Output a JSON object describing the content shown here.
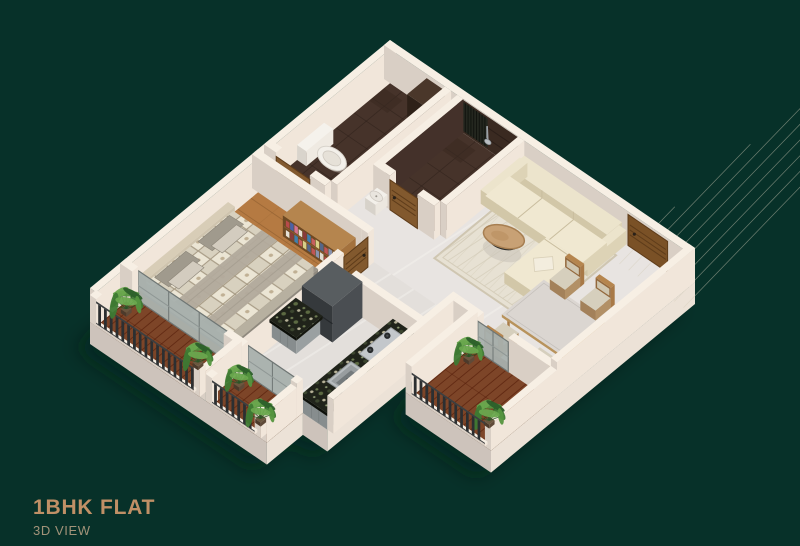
{
  "page": {
    "width": 800,
    "height": 546,
    "background": "#073129"
  },
  "caption": {
    "title": "1BHK FLAT",
    "subtitle": "3D VIEW",
    "title_color": "#c09066",
    "subtitle_color": "#a29379"
  },
  "scene": {
    "projection": {
      "ox": 390,
      "oy": 74,
      "ux": [
        3.05,
        2.08
      ],
      "vx": [
        -3.0,
        2.48
      ],
      "wall_h": 34
    },
    "palette": {
      "wall_top": "#f7efe4",
      "wall_se": "#f1e6da",
      "wall_sw": "#d9cfc5",
      "plinth_se": "#ece2d7",
      "plinth_sw": "#cdc3bb",
      "marble": "#e8e4e1",
      "marble2": "#e3dfdb",
      "wood_floor": "#b57a42",
      "wood_line": "#8f5f30",
      "deck": "#7d4528",
      "deck_line": "#571f0c",
      "tile_dark": "#46332a",
      "tile_line": "#2e211b",
      "rug": "#e7e1d3",
      "rug_line": "#d5cdba",
      "railing_dark": "#2c2f31",
      "glass": "#a8b0ad",
      "door_wood": "#82592e",
      "sofa_cream": "#ece4cc",
      "granite": "#20231a",
      "shadow": "#02211a"
    },
    "rooms": [
      "bedroom",
      "bathroom-wc",
      "bathroom-shower",
      "living-room",
      "dining-area",
      "kitchen",
      "bedroom-balcony",
      "kitchen-balcony",
      "dining-balcony"
    ],
    "elements": [
      {
        "t": "shadow",
        "name": "building-shadow",
        "pts": [
          [
            0,
            0
          ],
          [
            100,
            0
          ],
          [
            100,
            68
          ],
          [
            72,
            68
          ],
          [
            72,
            46
          ],
          [
            66,
            46
          ],
          [
            66,
            88
          ],
          [
            58,
            88
          ],
          [
            58,
            100
          ],
          [
            0,
            100
          ]
        ],
        "dx": -14,
        "dy": 26
      },
      {
        "t": "plinth",
        "name": "plinth-front-left",
        "edge": [
          0,
          100,
          58,
          100
        ],
        "side": "sw",
        "drop": 22
      },
      {
        "t": "plinth",
        "name": "plinth-kbal-e",
        "edge": [
          58,
          88,
          58,
          100
        ],
        "side": "se",
        "drop": 22
      },
      {
        "t": "plinth",
        "name": "plinth-kit-s",
        "edge": [
          58,
          88,
          66,
          88
        ],
        "side": "sw",
        "drop": 22
      },
      {
        "t": "plinth",
        "name": "plinth-kit-e",
        "edge": [
          66,
          46,
          66,
          88
        ],
        "side": "se",
        "drop": 22
      },
      {
        "t": "plinth",
        "name": "plinth-notch",
        "edge": [
          66,
          46,
          72,
          46
        ],
        "side": "sw",
        "drop": 22
      },
      {
        "t": "plinth",
        "name": "plinth-dbal-s",
        "edge": [
          72,
          68,
          100,
          68
        ],
        "side": "sw",
        "drop": 22
      },
      {
        "t": "plinth",
        "name": "plinth-e",
        "edge": [
          100,
          0,
          100,
          68
        ],
        "side": "se",
        "drop": 22
      },
      {
        "t": "floor",
        "name": "floor-living-marble",
        "rect": [
          0,
          0,
          100,
          46
        ],
        "tex": "marble"
      },
      {
        "t": "floor",
        "name": "floor-bath-wc",
        "rect": [
          0,
          2,
          20,
          40
        ],
        "tex": "tile"
      },
      {
        "t": "floor",
        "name": "floor-bath-shower",
        "rect": [
          24,
          2,
          44,
          28
        ],
        "tex": "tile"
      },
      {
        "t": "floor",
        "name": "floor-kitchen",
        "rect": [
          36,
          44,
          66,
          88
        ],
        "tex": "marble2"
      },
      {
        "t": "floor",
        "name": "floor-bedroom-wood",
        "rect": [
          0,
          44,
          36,
          88
        ],
        "tex": "wood"
      },
      {
        "t": "floor",
        "name": "floor-deck-bedroom",
        "rect": [
          0,
          88,
          36,
          100
        ],
        "tex": "deck"
      },
      {
        "t": "floor",
        "name": "floor-deck-kitchen",
        "rect": [
          38,
          88,
          58,
          100
        ],
        "tex": "deck"
      },
      {
        "t": "floor",
        "name": "floor-deck-dining",
        "rect": [
          72,
          46,
          100,
          68
        ],
        "tex": "deck"
      },
      {
        "t": "floor",
        "name": "living-room-rug",
        "rect": [
          48,
          6,
          80,
          34
        ],
        "tex": "rug"
      },
      {
        "t": "wall",
        "name": "wall-nw",
        "rect": [
          0,
          0,
          2,
          100
        ],
        "h": 34
      },
      {
        "t": "wall",
        "name": "wall-ne",
        "rect": [
          0,
          0,
          100,
          2
        ],
        "h": 34
      },
      {
        "t": "panelU",
        "name": "bath-shower-dark-wall",
        "c": 2,
        "a1": 24,
        "a2": 44,
        "h1": 0,
        "h2": 33,
        "fill": "#3a2a21",
        "hlines": 2,
        "lc": "#2c1f19"
      },
      {
        "t": "panelU",
        "name": "vent-slat-panel",
        "c": 2,
        "a1": 24.8,
        "a2": 34,
        "h1": 2,
        "h2": 31,
        "fill": "#24271f",
        "vlines": 9,
        "lc": "#12140f"
      },
      {
        "t": "shower",
        "name": "shower-head",
        "u": 34,
        "v": 2.2
      },
      {
        "t": "toilet",
        "name": "toilet-wc"
      },
      {
        "t": "prism",
        "name": "bath-dark-cabinet",
        "rect": [
          14,
          2,
          20,
          8.5
        ],
        "h": 30,
        "cols": {
          "t": "#4a372a",
          "se": "#3a2a1f",
          "sw": "#2e2118"
        }
      },
      {
        "t": "wall",
        "name": "wall-bath-divider",
        "rect": [
          20,
          2,
          22,
          40
        ],
        "h": 34
      },
      {
        "t": "wall",
        "name": "wall-bath2-w",
        "rect": [
          24,
          2,
          26,
          28
        ],
        "h": 34,
        "cols": {
          "t": "#f6eee3",
          "se": "#44312a",
          "sw": "#dcd2c8"
        }
      },
      {
        "t": "wall",
        "name": "wall-bath2-e",
        "rect": [
          44,
          2,
          46,
          28
        ],
        "h": 34
      },
      {
        "t": "wall",
        "name": "wall-bath2-s1",
        "rect": [
          24,
          28,
          29.5,
          30
        ],
        "h": 34
      },
      {
        "t": "wall",
        "name": "wall-bath2-s2",
        "rect": [
          38.5,
          28,
          44,
          30
        ],
        "h": 34
      },
      {
        "t": "door",
        "name": "bath-shower-door",
        "plane": "v",
        "c": 30,
        "a1": 29.5,
        "a2": 38.5,
        "h": 30
      },
      {
        "t": "basin",
        "name": "washbasin"
      },
      {
        "t": "wall",
        "name": "wall-bath1-s1",
        "rect": [
          0,
          40,
          4,
          42
        ],
        "h": 34
      },
      {
        "t": "wall",
        "name": "wall-bath1-s2",
        "rect": [
          15,
          40,
          20,
          42
        ],
        "h": 34
      },
      {
        "t": "door",
        "name": "bath-wc-door",
        "plane": "v",
        "c": 42,
        "a1": 4,
        "a2": 15,
        "h": 30
      },
      {
        "t": "door",
        "name": "entrance-door",
        "plane": "v",
        "c": 2,
        "a1": 80,
        "a2": 93,
        "h": 31,
        "fill": "#7a5126"
      },
      {
        "t": "wall",
        "name": "wall-bedroom-n",
        "rect": [
          0,
          44,
          36,
          46
        ],
        "h": 34
      },
      {
        "t": "bookshelf",
        "name": "bookshelf",
        "rect": [
          16,
          46,
          34,
          52
        ],
        "h": 21
      },
      {
        "t": "wall",
        "name": "wall-bedroom-e1",
        "rect": [
          36,
          44,
          38,
          46
        ],
        "h": 34
      },
      {
        "t": "wall",
        "name": "wall-bedroom-e2",
        "rect": [
          36,
          54,
          38,
          88
        ],
        "h": 34
      },
      {
        "t": "door",
        "name": "bedroom-door",
        "plane": "u",
        "c": 38,
        "a1": 46,
        "a2": 54,
        "h": 30
      },
      {
        "t": "bed",
        "name": "double-bed"
      },
      {
        "t": "sofa",
        "name": "l-shaped-sofa"
      },
      {
        "t": "ctable",
        "name": "coffee-table",
        "u": 58,
        "v": 21
      },
      {
        "t": "wall",
        "name": "wall-living-kitchen",
        "rect": [
          44,
          56,
          66,
          58
        ],
        "h": 34
      },
      {
        "t": "fridge",
        "name": "refrigerator",
        "rect": [
          38,
          58,
          48,
          68
        ],
        "h": 36
      },
      {
        "t": "counter",
        "name": "kitchen-counter-small",
        "rect": [
          36,
          68,
          44,
          76
        ],
        "h": 15
      },
      {
        "t": "counter",
        "name": "kitchen-counter-long",
        "rect": [
          58,
          58,
          66,
          88
        ],
        "h": 15
      },
      {
        "t": "stove",
        "name": "gas-stove",
        "rect": [
          59.3,
          60,
          64.7,
          70.5
        ]
      },
      {
        "t": "sink",
        "name": "kitchen-sink",
        "rect": [
          59.5,
          73.5,
          65,
          81.5
        ]
      },
      {
        "t": "wall",
        "name": "wall-kitchen-e",
        "rect": [
          66,
          46,
          68,
          88
        ],
        "h": 34
      },
      {
        "t": "dtable",
        "name": "dining-table",
        "rect": [
          76,
          26,
          96,
          40
        ]
      },
      {
        "t": "chair",
        "name": "dining-chair-1",
        "u": 78,
        "v": 21,
        "dir": "ne"
      },
      {
        "t": "chair",
        "name": "dining-chair-2",
        "u": 88,
        "v": 21,
        "dir": "ne"
      },
      {
        "t": "chair",
        "name": "dining-chair-3",
        "u": 79,
        "v": 42.5,
        "dir": "sw"
      },
      {
        "t": "chair",
        "name": "dining-chair-4",
        "u": 91,
        "v": 42.5,
        "dir": "sw"
      },
      {
        "t": "wall",
        "name": "wall-dining-s1",
        "rect": [
          68,
          46,
          76,
          48
        ],
        "h": 34
      },
      {
        "t": "wall",
        "name": "wall-dining-s2",
        "rect": [
          86,
          46,
          100,
          48
        ],
        "h": 34
      },
      {
        "t": "glass",
        "name": "dining-balcony-slider",
        "plane": "v",
        "c": 48,
        "a1": 76,
        "a2": 86,
        "h": 30,
        "n": 2
      },
      {
        "t": "wall",
        "name": "wall-dining-e",
        "rect": [
          98,
          0,
          100,
          46
        ],
        "h": 34
      },
      {
        "t": "wall",
        "name": "parapet-dining-balcony",
        "rect": [
          98,
          46,
          100,
          68
        ],
        "h": 26
      },
      {
        "t": "wall",
        "name": "wall-dbal-w",
        "rect": [
          72,
          46,
          74,
          68
        ],
        "h": 30
      },
      {
        "t": "plant",
        "name": "plant-dbal-1",
        "u": 76.5,
        "v": 51.5,
        "s": 1.0
      },
      {
        "t": "plant",
        "name": "plant-dbal-2",
        "u": 94,
        "v": 62.5,
        "s": 1.05
      },
      {
        "t": "railing",
        "name": "railing-dining-balcony",
        "c": 68,
        "a1": 74,
        "a2": 98,
        "h": 24
      },
      {
        "t": "glass",
        "name": "bedroom-balcony-slider",
        "plane": "v",
        "c": 88,
        "a1": 4,
        "a2": 34,
        "h": 30,
        "n": 3
      },
      {
        "t": "glass",
        "name": "kitchen-balcony-slider",
        "plane": "v",
        "c": 88,
        "a1": 40,
        "a2": 56,
        "h": 30,
        "n": 2
      },
      {
        "t": "wall",
        "name": "wall-bal-seg1",
        "rect": [
          0,
          88,
          4,
          90
        ],
        "h": 34
      },
      {
        "t": "wall",
        "name": "wall-bal-seg2",
        "rect": [
          34,
          88,
          40,
          90
        ],
        "h": 34
      },
      {
        "t": "wall",
        "name": "wall-bal-seg3",
        "rect": [
          56,
          88,
          58,
          90
        ],
        "h": 34
      },
      {
        "t": "wall",
        "name": "wall-balcony-divider",
        "rect": [
          36,
          88,
          38,
          100
        ],
        "h": 30
      },
      {
        "t": "wall",
        "name": "wall-kbal-e",
        "rect": [
          56,
          90,
          58,
          100
        ],
        "h": 30
      },
      {
        "t": "wall",
        "name": "post-1",
        "rect": [
          0,
          98,
          2,
          100
        ],
        "h": 27
      },
      {
        "t": "wall",
        "name": "post-2",
        "rect": [
          34,
          98,
          36,
          100
        ],
        "h": 27
      },
      {
        "t": "wall",
        "name": "post-3",
        "rect": [
          38,
          98,
          40,
          100
        ],
        "h": 27
      },
      {
        "t": "wall",
        "name": "post-4",
        "rect": [
          54,
          98,
          56,
          100
        ],
        "h": 27
      },
      {
        "t": "railing",
        "name": "railing-bedroom-balcony",
        "c": 100,
        "a1": 2,
        "a2": 34,
        "h": 25
      },
      {
        "t": "railing",
        "name": "railing-kitchen-balcony",
        "c": 100,
        "a1": 40,
        "a2": 54,
        "h": 25
      },
      {
        "t": "plant",
        "name": "plant-bbal-1",
        "u": 4.5,
        "v": 92.5,
        "s": 1.1
      },
      {
        "t": "plant",
        "name": "plant-bbal-2",
        "u": 29,
        "v": 93.5,
        "s": 1.0
      },
      {
        "t": "plant",
        "name": "plant-kbal-1",
        "u": 41,
        "v": 92,
        "s": 0.95
      },
      {
        "t": "plant",
        "name": "plant-kbal-2",
        "u": 52.5,
        "v": 96.5,
        "s": 1.0
      }
    ]
  }
}
